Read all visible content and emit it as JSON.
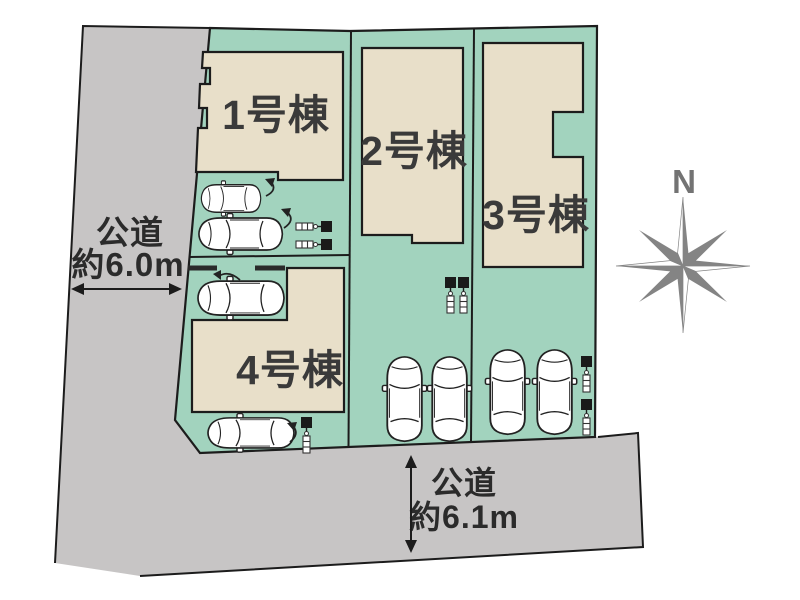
{
  "site_plan": {
    "buildings": [
      {
        "label": "1号棟"
      },
      {
        "label": "2号棟"
      },
      {
        "label": "3号棟"
      },
      {
        "label": "4号棟"
      }
    ],
    "roads": {
      "west": {
        "name": "公道",
        "width": "約6.0m"
      },
      "south": {
        "name": "公道",
        "width": "約6.1m"
      }
    },
    "compass": {
      "north_label": "N"
    },
    "cars_count": 8,
    "utility_pole_icons_count": 7,
    "colors": {
      "lot_green": "#a2d3be",
      "building_beige": "#e8dfc9",
      "road_gray": "#c7c5c5",
      "outline": "#1c1c1c",
      "compass_gray": "#848484",
      "text_dark": "#3a3a3a"
    }
  }
}
